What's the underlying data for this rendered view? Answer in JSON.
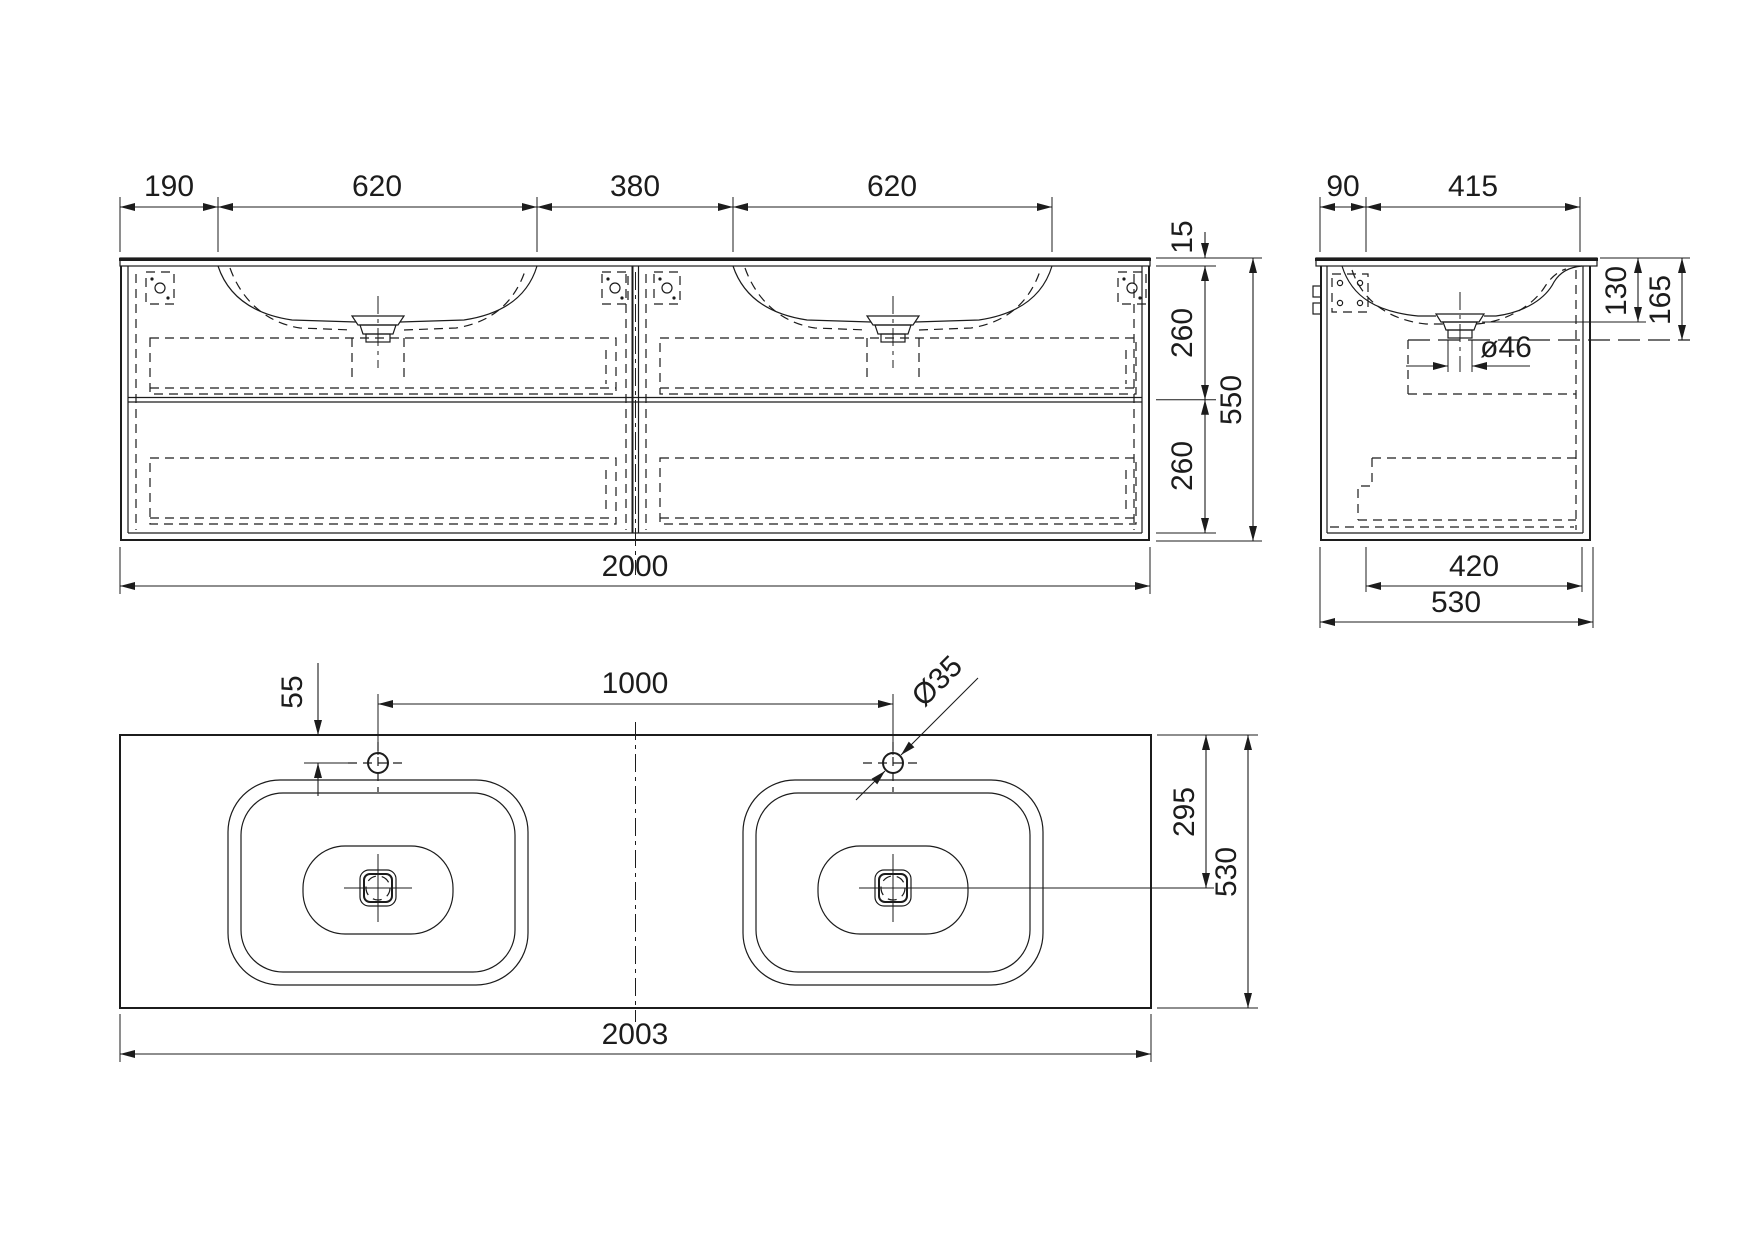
{
  "views": {
    "front": {
      "d190": "190",
      "d620a": "620",
      "d380": "380",
      "d620b": "620",
      "d15": "15",
      "d260a": "260",
      "d260b": "260",
      "d550": "550",
      "d2000": "2000"
    },
    "side": {
      "d90": "90",
      "d415": "415",
      "d130": "130",
      "d165": "165",
      "d46": "ø46",
      "d420": "420",
      "d530": "530"
    },
    "plan": {
      "d55": "55",
      "d1000": "1000",
      "d35": "Ø35",
      "d295": "295",
      "d530": "530",
      "d2003": "2003"
    }
  }
}
